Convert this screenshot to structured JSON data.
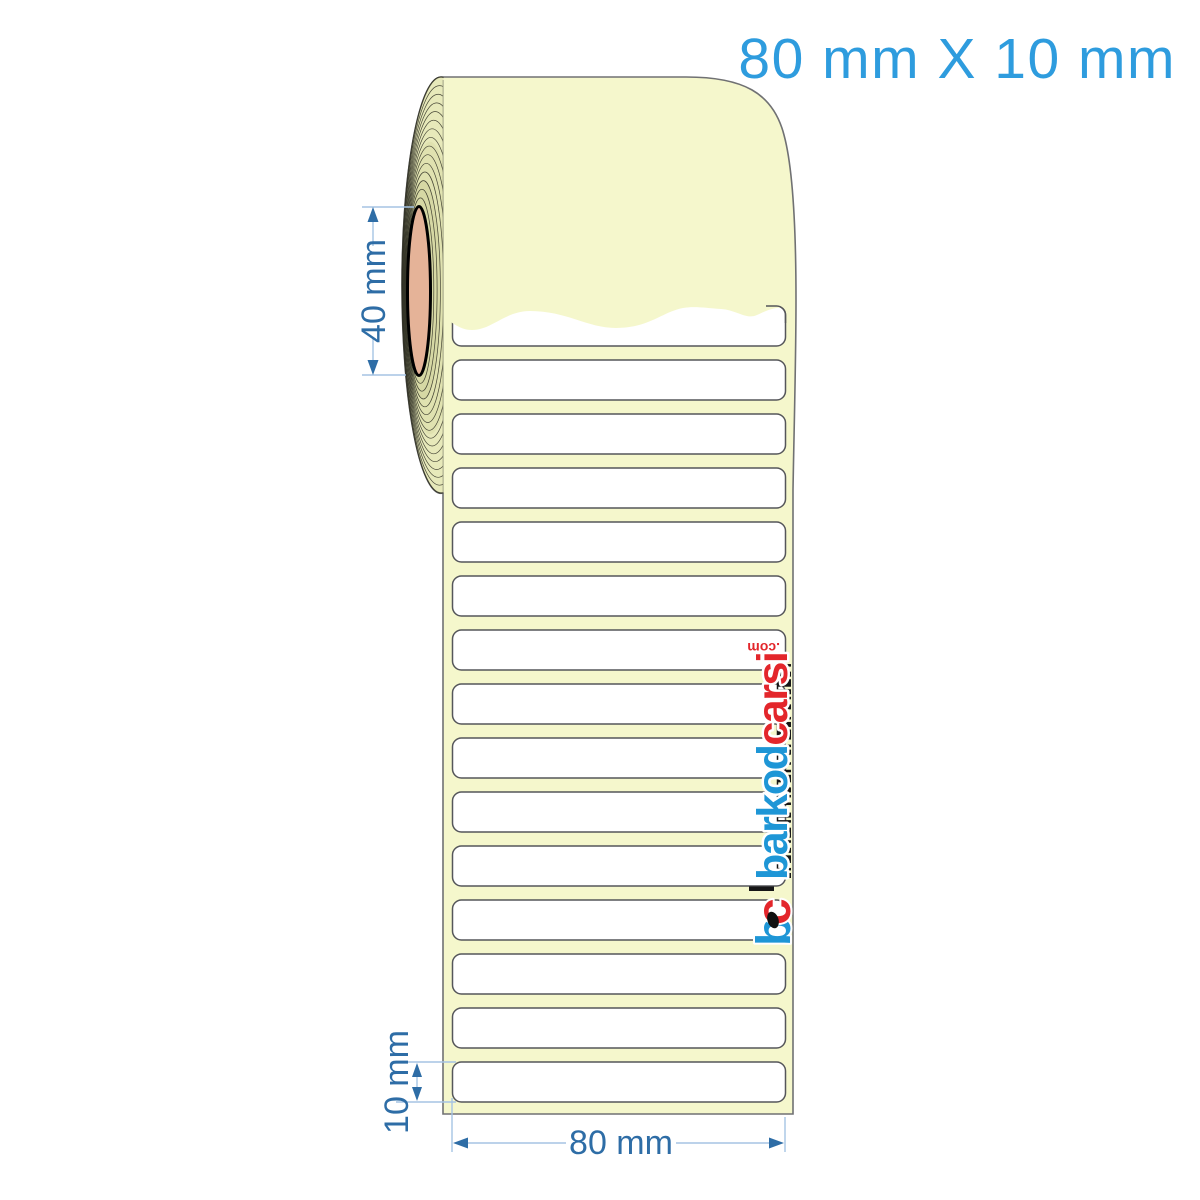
{
  "colors": {
    "cream": "#F5F7CC",
    "roll-side": "#E7E9BA",
    "roll-side-mid": "#E0E2B0",
    "roll-side-deep": "#D6D8A4",
    "core-salmon": "#E5B398",
    "outline-gray": "#707173",
    "label-white": "#FFFFFF",
    "label-border": "#55565A",
    "title-blue": "#2E9CDE",
    "dim-blue": "#2E6DA6",
    "dim-line": "#A5C4E4",
    "brand-blue": "#1E96D6",
    "brand-red": "#E3262B",
    "ink-black": "#161616"
  },
  "title": {
    "text": "80 mm X 10 mm"
  },
  "dimensions": {
    "core_diameter": "40 mm",
    "label_height": "10 mm",
    "label_width": "80 mm"
  },
  "roll": {
    "label_count_visible": 15
  },
  "watermark": {
    "brand_blue_part": "barkod",
    "brand_red_part": "carsi",
    "brand_tld": ".com",
    "monogram_b": "b",
    "monogram_c": "c"
  }
}
